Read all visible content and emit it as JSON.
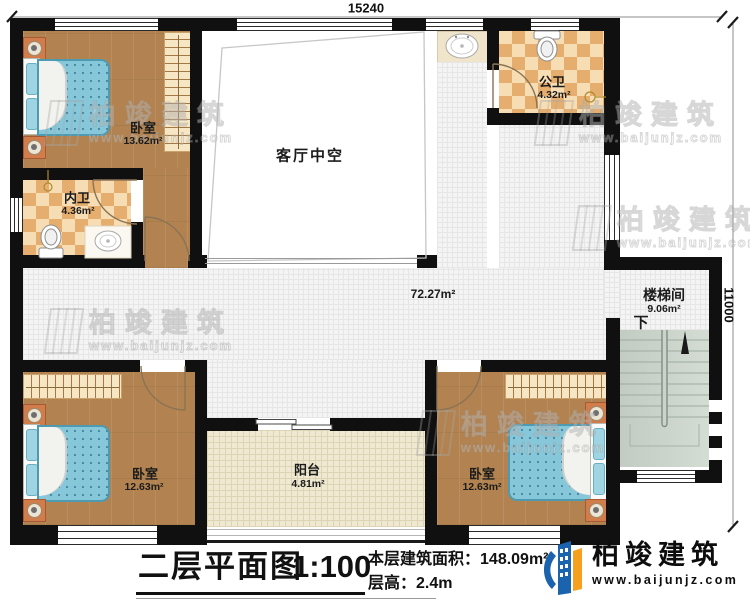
{
  "dimensions": {
    "top": "15240",
    "right": "11000"
  },
  "rooms": {
    "bedroom_tl": {
      "name": "卧室",
      "area": "13.62m²"
    },
    "bathroom_inner": {
      "name": "内卫",
      "area": "4.36m²"
    },
    "bathroom_public": {
      "name": "公卫",
      "area": "4.32m²"
    },
    "living_void": {
      "name": "客厅中空"
    },
    "hallway": {
      "area": "72.27m²"
    },
    "stairwell": {
      "name": "楼梯间",
      "area": "9.06m²",
      "direction_label": "下"
    },
    "bedroom_bl": {
      "name": "卧室",
      "area": "12.63m²"
    },
    "bedroom_br": {
      "name": "卧室",
      "area": "12.63m²"
    },
    "balcony": {
      "name": "阳台",
      "area": "4.81m²"
    }
  },
  "caption": {
    "plan_title": "二层平面图",
    "scale": "1:100",
    "floor_area_label": "本层建筑面积：",
    "floor_area_value": "148.09m²",
    "floor_height_label": "层高：",
    "floor_height_value": "2.4m"
  },
  "brand": {
    "name": "柏竣建筑",
    "website": "www.baijunjz.com"
  },
  "watermark": {
    "name": "柏竣建筑",
    "website": "www.baijunjz.com"
  },
  "colors": {
    "wall": "#101010",
    "wood": "#b28350",
    "checker": "#e5ae6e",
    "tile": "#f4f4f4",
    "balcony_tile": "#efe9d2",
    "stair": "#ccd5cc",
    "mattress": "#87c7da",
    "brand_blue": "#1b63ad",
    "brand_orange": "#f7a01d"
  }
}
